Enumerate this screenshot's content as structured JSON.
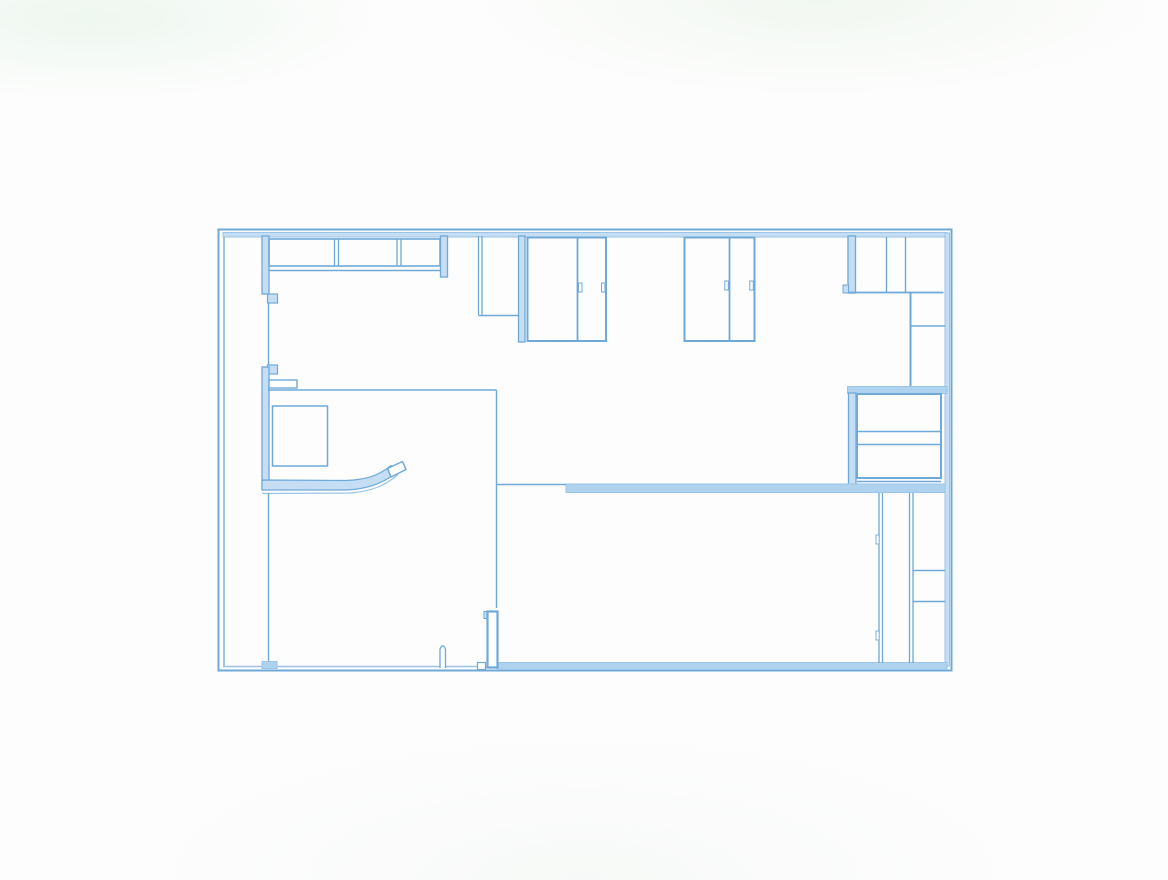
{
  "meta": {
    "kind": "architectural-floor-plan-blueprint",
    "canvas": {
      "width": 1168,
      "height": 880
    }
  },
  "colors": {
    "stroke": "#6fa9d8",
    "soft": "#9ac4e8",
    "fill": "#c6def3",
    "fillMid": "#afd3ee",
    "white": "#ffffff",
    "none": "none"
  },
  "plan": {
    "elements": [
      {
        "t": "line",
        "name": "outer-wall-left-outer",
        "x1": 218.5,
        "y1": 228.5,
        "x2": 218.5,
        "y2": 671.5,
        "w": 2,
        "c": "stroke"
      },
      {
        "t": "line",
        "name": "outer-wall-left-inner",
        "x1": 224,
        "y1": 234,
        "x2": 224,
        "y2": 666,
        "w": 2,
        "c": "soft"
      },
      {
        "t": "line",
        "name": "outer-wall-top-outer",
        "x1": 217.5,
        "y1": 229.5,
        "x2": 952.5,
        "y2": 229.5,
        "w": 2,
        "c": "stroke"
      },
      {
        "t": "rect",
        "name": "outer-wall-top-band",
        "x": 223,
        "y": 232.5,
        "w": 724,
        "h": 4.5,
        "f": "fill",
        "s": "soft",
        "sw": 1
      },
      {
        "t": "line",
        "name": "outer-wall-right-outer",
        "x1": 951.5,
        "y1": 228.5,
        "x2": 951.5,
        "y2": 671.5,
        "w": 2,
        "c": "stroke"
      },
      {
        "t": "rect",
        "name": "outer-wall-right-band",
        "x": 945,
        "y": 233,
        "w": 4.5,
        "h": 433,
        "f": "fill",
        "s": "soft",
        "sw": 1
      },
      {
        "t": "line",
        "name": "outer-wall-bottom-outer",
        "x1": 217.5,
        "y1": 670.5,
        "x2": 952.5,
        "y2": 670.5,
        "w": 2,
        "c": "stroke"
      },
      {
        "t": "line",
        "name": "outer-wall-bottom-inner",
        "x1": 223,
        "y1": 666.5,
        "x2": 947,
        "y2": 666.5,
        "w": 1.5,
        "c": "soft"
      },
      {
        "t": "rect",
        "name": "bottom-wall-thick-band",
        "x": 497,
        "y": 662.5,
        "w": 450,
        "h": 7,
        "f": "fillMid",
        "s": "soft",
        "sw": 1
      },
      {
        "t": "rect",
        "name": "left-wall-upper-segment",
        "x": 262,
        "y": 236,
        "w": 7,
        "h": 58,
        "f": "fill",
        "s": "stroke",
        "sw": 1.3
      },
      {
        "t": "rect",
        "name": "left-wall-jamb-upper",
        "x": 267.5,
        "y": 294,
        "w": 10,
        "h": 9,
        "f": "fill",
        "s": "stroke",
        "sw": 1.2
      },
      {
        "t": "line",
        "name": "left-wall-opening-line",
        "x1": 268.5,
        "y1": 303,
        "x2": 268.5,
        "y2": 365,
        "w": 1.4,
        "c": "stroke"
      },
      {
        "t": "rect",
        "name": "left-wall-jamb-lower",
        "x": 267.5,
        "y": 365,
        "w": 10,
        "h": 9,
        "f": "fill",
        "s": "stroke",
        "sw": 1.2
      },
      {
        "t": "rect",
        "name": "left-wall-lower-segment",
        "x": 262,
        "y": 367,
        "w": 7,
        "h": 122,
        "f": "fill",
        "s": "stroke",
        "sw": 1.3
      },
      {
        "t": "rect",
        "name": "left-wall-stub",
        "x": 269,
        "y": 380,
        "w": 28,
        "h": 8,
        "f": "white",
        "s": "stroke",
        "sw": 1.4
      },
      {
        "t": "rect",
        "name": "cabinet-run-outline",
        "x": 269,
        "y": 239,
        "w": 171,
        "h": 27,
        "f": "none",
        "s": "stroke",
        "sw": 1.6
      },
      {
        "t": "line",
        "name": "cabinet-divider-1-left",
        "x1": 334.5,
        "y1": 239,
        "x2": 334.5,
        "y2": 266,
        "w": 1.3,
        "c": "stroke"
      },
      {
        "t": "line",
        "name": "cabinet-divider-1-right",
        "x1": 338.5,
        "y1": 239,
        "x2": 338.5,
        "y2": 266,
        "w": 1.3,
        "c": "stroke"
      },
      {
        "t": "line",
        "name": "cabinet-divider-2-left",
        "x1": 397,
        "y1": 239,
        "x2": 397,
        "y2": 266,
        "w": 1.3,
        "c": "stroke"
      },
      {
        "t": "line",
        "name": "cabinet-divider-2-right",
        "x1": 401,
        "y1": 239,
        "x2": 401,
        "y2": 266,
        "w": 1.3,
        "c": "stroke"
      },
      {
        "t": "line",
        "name": "cabinet-run-baseline",
        "x1": 269,
        "y1": 270.5,
        "x2": 448,
        "y2": 270.5,
        "w": 1.4,
        "c": "stroke"
      },
      {
        "t": "rect",
        "name": "wall-return-top",
        "x": 440.5,
        "y": 236,
        "w": 7,
        "h": 41,
        "f": "fill",
        "s": "stroke",
        "sw": 1.3
      },
      {
        "t": "line",
        "name": "partition-478-left",
        "x1": 478.5,
        "y1": 236,
        "x2": 478.5,
        "y2": 315,
        "w": 1.3,
        "c": "stroke"
      },
      {
        "t": "line",
        "name": "partition-478-right",
        "x1": 482,
        "y1": 236,
        "x2": 482,
        "y2": 315,
        "w": 1.3,
        "c": "stroke"
      },
      {
        "t": "line",
        "name": "partition-478-base",
        "x1": 478.5,
        "y1": 315.5,
        "x2": 519,
        "y2": 315.5,
        "w": 1.4,
        "c": "stroke"
      },
      {
        "t": "rect",
        "name": "wall-pier-518",
        "x": 518.5,
        "y": 236,
        "w": 6.5,
        "h": 106,
        "f": "fill",
        "s": "stroke",
        "sw": 1.3
      },
      {
        "t": "rect",
        "name": "room-a-outline",
        "x": 527.5,
        "y": 237.5,
        "w": 78.5,
        "h": 103.5,
        "f": "none",
        "s": "stroke",
        "sw": 2
      },
      {
        "t": "line",
        "name": "room-a-divider",
        "x1": 577.5,
        "y1": 237.5,
        "x2": 577.5,
        "y2": 341,
        "w": 1.8,
        "c": "stroke"
      },
      {
        "t": "rect",
        "name": "room-a-divider-jamb",
        "x": 578.5,
        "y": 283,
        "w": 3.5,
        "h": 9,
        "f": "white",
        "s": "stroke",
        "sw": 1
      },
      {
        "t": "rect",
        "name": "room-a-right-jamb",
        "x": 601.5,
        "y": 283,
        "w": 3.5,
        "h": 9,
        "f": "white",
        "s": "stroke",
        "sw": 1
      },
      {
        "t": "rect",
        "name": "room-b-outline",
        "x": 684.5,
        "y": 237.5,
        "w": 70,
        "h": 103.5,
        "f": "none",
        "s": "stroke",
        "sw": 2
      },
      {
        "t": "line",
        "name": "room-b-divider",
        "x1": 729.5,
        "y1": 237.5,
        "x2": 729.5,
        "y2": 341,
        "w": 1.8,
        "c": "stroke"
      },
      {
        "t": "rect",
        "name": "room-b-divider-jamb",
        "x": 724.8,
        "y": 281,
        "w": 3.5,
        "h": 9,
        "f": "white",
        "s": "stroke",
        "sw": 1
      },
      {
        "t": "rect",
        "name": "room-b-right-jamb",
        "x": 749.8,
        "y": 281,
        "w": 3.5,
        "h": 9,
        "f": "white",
        "s": "stroke",
        "sw": 1
      },
      {
        "t": "rect",
        "name": "wall-847-upper",
        "x": 848,
        "y": 236,
        "w": 7.5,
        "h": 57,
        "f": "fill",
        "s": "stroke",
        "sw": 1.3
      },
      {
        "t": "rect",
        "name": "wall-847-foot",
        "x": 843,
        "y": 285,
        "w": 5.5,
        "h": 8,
        "f": "fill",
        "s": "stroke",
        "sw": 1
      },
      {
        "t": "line",
        "name": "closet-row-baseline",
        "x1": 848,
        "y1": 292.5,
        "x2": 943.5,
        "y2": 292.5,
        "w": 1.8,
        "c": "stroke"
      },
      {
        "t": "line",
        "name": "closet-divider-1",
        "x1": 886.5,
        "y1": 237,
        "x2": 886.5,
        "y2": 292,
        "w": 1.4,
        "c": "stroke"
      },
      {
        "t": "line",
        "name": "closet-divider-2",
        "x1": 905.5,
        "y1": 237,
        "x2": 905.5,
        "y2": 292,
        "w": 1.4,
        "c": "stroke"
      },
      {
        "t": "line",
        "name": "right-column-wall",
        "x1": 910.5,
        "y1": 293,
        "x2": 910.5,
        "y2": 386,
        "w": 2,
        "c": "stroke"
      },
      {
        "t": "line",
        "name": "right-column-divider",
        "x1": 910.5,
        "y1": 326,
        "x2": 945,
        "y2": 326,
        "w": 1.4,
        "c": "stroke"
      },
      {
        "t": "rect",
        "name": "wall-mid-right-band",
        "x": 847.5,
        "y": 386.5,
        "w": 99.5,
        "h": 7,
        "f": "fillMid",
        "s": "soft",
        "sw": 1
      },
      {
        "t": "rect",
        "name": "wall-847-lower",
        "x": 848.5,
        "y": 393,
        "w": 7.5,
        "h": 98,
        "f": "fill",
        "s": "stroke",
        "sw": 1.3
      },
      {
        "t": "rect",
        "name": "utility-box-outline",
        "x": 857,
        "y": 394,
        "w": 84,
        "h": 84,
        "f": "none",
        "s": "stroke",
        "sw": 2
      },
      {
        "t": "line",
        "name": "utility-box-shelf-1",
        "x1": 857,
        "y1": 431.5,
        "x2": 941,
        "y2": 431.5,
        "w": 1.5,
        "c": "stroke"
      },
      {
        "t": "line",
        "name": "utility-box-shelf-2",
        "x1": 857,
        "y1": 444.5,
        "x2": 941,
        "y2": 444.5,
        "w": 1.5,
        "c": "stroke"
      },
      {
        "t": "line",
        "name": "utility-box-base",
        "x1": 857,
        "y1": 481.5,
        "x2": 941,
        "y2": 481.5,
        "w": 1.5,
        "c": "stroke"
      },
      {
        "t": "rect",
        "name": "wall-low-right-band",
        "x": 566,
        "y": 484,
        "w": 379,
        "h": 8.5,
        "f": "fillMid",
        "s": "soft",
        "sw": 1
      },
      {
        "t": "line",
        "name": "wall-low-thin-link",
        "x1": 497,
        "y1": 484.5,
        "x2": 566,
        "y2": 484.5,
        "w": 1.4,
        "c": "stroke"
      },
      {
        "t": "line",
        "name": "left-room-top-edge",
        "x1": 268,
        "y1": 390,
        "x2": 496.5,
        "y2": 390,
        "w": 1.4,
        "c": "stroke"
      },
      {
        "t": "line",
        "name": "left-room-right-edge",
        "x1": 496.5,
        "y1": 390,
        "x2": 496.5,
        "y2": 608,
        "w": 1.4,
        "c": "stroke"
      },
      {
        "t": "rect",
        "name": "closet-box",
        "x": 272.5,
        "y": 406,
        "w": 55,
        "h": 60,
        "f": "none",
        "s": "stroke",
        "sw": 1.5
      },
      {
        "t": "path",
        "name": "counter-curved-wall",
        "d": "M 262,480 L 345,480.5 C 366,480 379,475.5 391,465.5 L 396.5,472.5 C 383,483.5 367,489.5 345,490 L 262,490 Z",
        "f": "fill",
        "s": "stroke",
        "sw": 1.2
      },
      {
        "t": "path",
        "name": "counter-curve-underline",
        "d": "M 262,493.5 L 350,493 C 372,491.5 386,485 398,474.5",
        "f": "none",
        "s": "soft",
        "sw": 1.2
      },
      {
        "t": "path",
        "name": "counter-end-cap",
        "d": "M 387.5,468.5 L 402.5,461.5 L 406,469.5 L 391,477 Z",
        "f": "white",
        "s": "stroke",
        "sw": 1.5
      },
      {
        "t": "line",
        "name": "left-room-wall-line",
        "x1": 268.5,
        "y1": 493,
        "x2": 268.5,
        "y2": 662,
        "w": 1.4,
        "c": "stroke"
      },
      {
        "t": "rect",
        "name": "left-wall-base-foot",
        "x": 262,
        "y": 661.5,
        "w": 15,
        "h": 7,
        "f": "fillMid",
        "s": "soft",
        "sw": 1
      },
      {
        "t": "rect",
        "name": "door-pier-notch",
        "x": 484,
        "y": 611.5,
        "w": 5,
        "h": 7,
        "f": "fill",
        "s": "stroke",
        "sw": 1
      },
      {
        "t": "rect",
        "name": "door-pier",
        "x": 487.5,
        "y": 611.5,
        "w": 10,
        "h": 56,
        "f": "white",
        "s": "stroke",
        "sw": 2.2
      },
      {
        "t": "path",
        "name": "door-stop-pillar",
        "d": "M 440,668 L 440,649 Q 442.5,642.5 445.5,649 L 445.5,668",
        "f": "white",
        "s": "stroke",
        "sw": 1.3
      },
      {
        "t": "rect",
        "name": "threshold-notch",
        "x": 477.5,
        "y": 662.5,
        "w": 8,
        "h": 7,
        "f": "white",
        "s": "stroke",
        "sw": 1.2
      },
      {
        "t": "line",
        "name": "corridor-wall-left-a",
        "x1": 879,
        "y1": 493,
        "x2": 879,
        "y2": 663,
        "w": 1.3,
        "c": "stroke"
      },
      {
        "t": "line",
        "name": "corridor-wall-left-b",
        "x1": 882.5,
        "y1": 493,
        "x2": 882.5,
        "y2": 663,
        "w": 1.3,
        "c": "stroke"
      },
      {
        "t": "line",
        "name": "corridor-wall-right-a",
        "x1": 909.5,
        "y1": 493,
        "x2": 909.5,
        "y2": 663,
        "w": 1.3,
        "c": "stroke"
      },
      {
        "t": "line",
        "name": "corridor-wall-right-b",
        "x1": 913,
        "y1": 493,
        "x2": 913,
        "y2": 663,
        "w": 1.3,
        "c": "stroke"
      },
      {
        "t": "line",
        "name": "right-cell-divider-1",
        "x1": 913,
        "y1": 570.5,
        "x2": 945,
        "y2": 570.5,
        "w": 1.5,
        "c": "stroke"
      },
      {
        "t": "line",
        "name": "right-cell-divider-2",
        "x1": 913,
        "y1": 601.5,
        "x2": 945,
        "y2": 601.5,
        "w": 1.5,
        "c": "stroke"
      },
      {
        "t": "rect",
        "name": "corridor-jamb-1",
        "x": 876,
        "y": 535,
        "w": 3.2,
        "h": 9,
        "f": "white",
        "s": "stroke",
        "sw": 0.9
      },
      {
        "t": "rect",
        "name": "corridor-jamb-2",
        "x": 876,
        "y": 631,
        "w": 3.2,
        "h": 9,
        "f": "white",
        "s": "stroke",
        "sw": 0.9
      }
    ]
  }
}
